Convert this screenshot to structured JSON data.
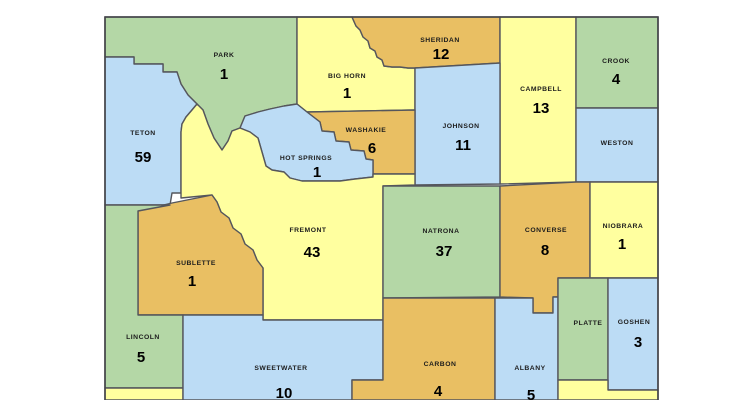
{
  "map": {
    "description": "Wyoming county map with per-county counts",
    "background_color": "#ffffff",
    "border_color": "#55565c",
    "outer_border_color": "#44454a",
    "palette": {
      "green": "#b4d7a6",
      "blue": "#bcdcf5",
      "yellow": "#ffff9f",
      "orange": "#e9bf63"
    },
    "bounds": {
      "left": 105,
      "top": 17,
      "right": 658,
      "bottom": 400
    },
    "counties": [
      {
        "id": "park",
        "label": "PARK",
        "value": "1",
        "color": "green",
        "lx": 224,
        "ly": 57,
        "vx": 224,
        "vy": 79,
        "path": "M105,17 L297,17 L297,104 L284,106 L270,109 L258,112 L245,116 L240,128 L232,131 L228,141 L222,150 L214,138 L208,124 L203,110 L197,104 L188,95 L181,84 L177,72 L163,72 L163,64 L134,64 L134,57 L105,57 Z"
      },
      {
        "id": "teton",
        "label": "TETON",
        "value": "59",
        "color": "blue",
        "lx": 143,
        "ly": 135,
        "vx": 143,
        "vy": 162,
        "path": "M105,57 L134,57 L134,64 L163,64 L163,72 L177,72 L181,84 L188,95 L197,104 L192,110 L186,117 L182,124 L181,132 L181,193 L172,193 L170,205 L105,205 Z"
      },
      {
        "id": "big-horn",
        "label": "BIG HORN",
        "value": "1",
        "color": "yellow",
        "lx": 347,
        "ly": 78,
        "vx": 347,
        "vy": 98,
        "path": "M297,17 L352,17 L356,26 L360,30 L363,37 L368,41 L370,48 L375,51 L377,57 L382,60 L384,66 L392,67 L400,67 L408,68 L415,68 L415,110 L307,112 L297,104 Z"
      },
      {
        "id": "sheridan",
        "label": "SHERIDAN",
        "value": "12",
        "color": "orange",
        "lx": 440,
        "ly": 42,
        "vx": 441,
        "vy": 59,
        "path": "M352,17 L500,17 L500,63 L415,68 L408,68 L400,67 L392,67 L384,66 L382,60 L377,57 L375,51 L370,48 L368,41 L363,37 L360,30 L356,26 Z"
      },
      {
        "id": "campbell",
        "label": "CAMPBELL",
        "value": "13",
        "color": "yellow",
        "lx": 541,
        "ly": 91,
        "vx": 541,
        "vy": 113,
        "path": "M500,17 L576,17 L576,182 L500,184 Z"
      },
      {
        "id": "crook",
        "label": "CROOK",
        "value": "4",
        "color": "green",
        "lx": 616,
        "ly": 63,
        "vx": 616,
        "vy": 84,
        "path": "M576,17 L658,17 L658,108 L576,108 Z"
      },
      {
        "id": "weston",
        "label": "WESTON",
        "value": "",
        "color": "blue",
        "lx": 617,
        "ly": 145,
        "vx": 617,
        "vy": 165,
        "path": "M576,108 L658,108 L658,182 L576,182 Z"
      },
      {
        "id": "johnson",
        "label": "JOHNSON",
        "value": "11",
        "color": "blue",
        "lx": 461,
        "ly": 128,
        "vx": 463,
        "vy": 150,
        "path": "M415,68 L500,63 L500,184 L415,185 Z"
      },
      {
        "id": "washakie",
        "label": "WASHAKIE",
        "value": "6",
        "color": "orange",
        "lx": 366,
        "ly": 132,
        "vx": 372,
        "vy": 153,
        "path": "M307,112 L415,110 L415,174 L373,174 L373,160 L366,159 L364,151 L351,150 L349,142 L336,141 L334,132 L322,131 L320,122 Z"
      },
      {
        "id": "hot-springs",
        "label": "HOT SPRINGS",
        "value": "1",
        "color": "blue",
        "lx": 306,
        "ly": 160,
        "vx": 317,
        "vy": 177,
        "path": "M245,116 L258,112 L270,109 L284,106 L297,104 L307,112 L320,122 L322,131 L334,132 L336,141 L349,142 L351,150 L364,151 L366,159 L373,160 L373,177 L355,179 L340,181 L302,181 L290,178 L284,172 L272,170 L266,166 L262,152 L258,138 L250,132 L240,128 Z"
      },
      {
        "id": "fremont",
        "label": "FREMONT",
        "value": "43",
        "color": "yellow",
        "lx": 308,
        "ly": 232,
        "vx": 312,
        "vy": 257,
        "path": "M181,132 L182,124 L186,117 L192,110 L197,104 L203,110 L208,124 L214,138 L222,150 L228,141 L232,131 L240,128 L250,132 L258,138 L262,152 L266,166 L272,170 L284,172 L290,178 L302,181 L340,181 L355,179 L373,177 L373,174 L415,174 L415,185 L383,186 L383,320 L263,320 L263,268 L257,260 L253,250 L245,244 L241,234 L233,228 L229,218 L221,212 L217,202 L212,195 L181,198 Z"
      },
      {
        "id": "sublette",
        "label": "SUBLETTE",
        "value": "1",
        "color": "orange",
        "lx": 196,
        "ly": 265,
        "vx": 192,
        "vy": 286,
        "path": "M138,211 L172,203 L212,195 L217,202 L221,212 L229,218 L233,228 L241,234 L245,244 L253,250 L257,260 L263,268 L263,315 L138,315 Z"
      },
      {
        "id": "lincoln",
        "label": "LINCOLN",
        "value": "5",
        "color": "green",
        "lx": 143,
        "ly": 339,
        "vx": 141,
        "vy": 362,
        "path": "M105,205 L170,205 L138,211 L138,315 L183,315 L183,388 L105,388 Z"
      },
      {
        "id": "uinta",
        "label": "",
        "value": "",
        "color": "yellow",
        "lx": 144,
        "ly": 398,
        "vx": 144,
        "vy": 398,
        "path": "M105,388 L183,388 L183,400 L105,400 Z"
      },
      {
        "id": "sweetwater",
        "label": "SWEETWATER",
        "value": "10",
        "color": "blue",
        "lx": 281,
        "ly": 370,
        "vx": 284,
        "vy": 398,
        "path": "M183,315 L263,315 L263,320 L383,320 L383,380 L352,380 L352,400 L183,400 Z"
      },
      {
        "id": "natrona",
        "label": "NATRONA",
        "value": "37",
        "color": "green",
        "lx": 441,
        "ly": 233,
        "vx": 444,
        "vy": 256,
        "path": "M383,186 L500,186 L500,297 L383,298 Z"
      },
      {
        "id": "converse",
        "label": "CONVERSE",
        "value": "8",
        "color": "orange",
        "lx": 546,
        "ly": 232,
        "vx": 545,
        "vy": 255,
        "path": "M500,186 L576,182 L590,182 L590,278 L558,278 L558,297 L553,297 L553,313 L533,313 L533,298 L500,297 Z"
      },
      {
        "id": "niobrara",
        "label": "NIOBRARA",
        "value": "1",
        "color": "yellow",
        "lx": 623,
        "ly": 228,
        "vx": 622,
        "vy": 249,
        "path": "M590,182 L658,182 L658,278 L590,278 Z"
      },
      {
        "id": "carbon",
        "label": "CARBON",
        "value": "4",
        "color": "orange",
        "lx": 440,
        "ly": 366,
        "vx": 438,
        "vy": 396,
        "path": "M383,298 L495,298 L495,400 L352,400 L352,380 L383,380 Z"
      },
      {
        "id": "albany",
        "label": "ALBANY",
        "value": "5",
        "color": "blue",
        "lx": 530,
        "ly": 370,
        "vx": 531,
        "vy": 400,
        "path": "M495,298 L533,298 L533,313 L553,313 L553,297 L558,297 L558,400 L495,400 Z"
      },
      {
        "id": "platte",
        "label": "PLATTE",
        "value": "",
        "color": "green",
        "lx": 588,
        "ly": 325,
        "vx": 588,
        "vy": 345,
        "path": "M558,278 L608,278 L608,380 L558,380 Z"
      },
      {
        "id": "goshen",
        "label": "GOSHEN",
        "value": "3",
        "color": "blue",
        "lx": 634,
        "ly": 324,
        "vx": 638,
        "vy": 347,
        "path": "M608,278 L658,278 L658,390 L608,390 Z"
      },
      {
        "id": "laramie",
        "label": "",
        "value": "",
        "color": "yellow",
        "lx": 608,
        "ly": 398,
        "vx": 608,
        "vy": 398,
        "path": "M558,380 L608,380 L608,390 L658,390 L658,400 L558,400 Z"
      }
    ]
  }
}
